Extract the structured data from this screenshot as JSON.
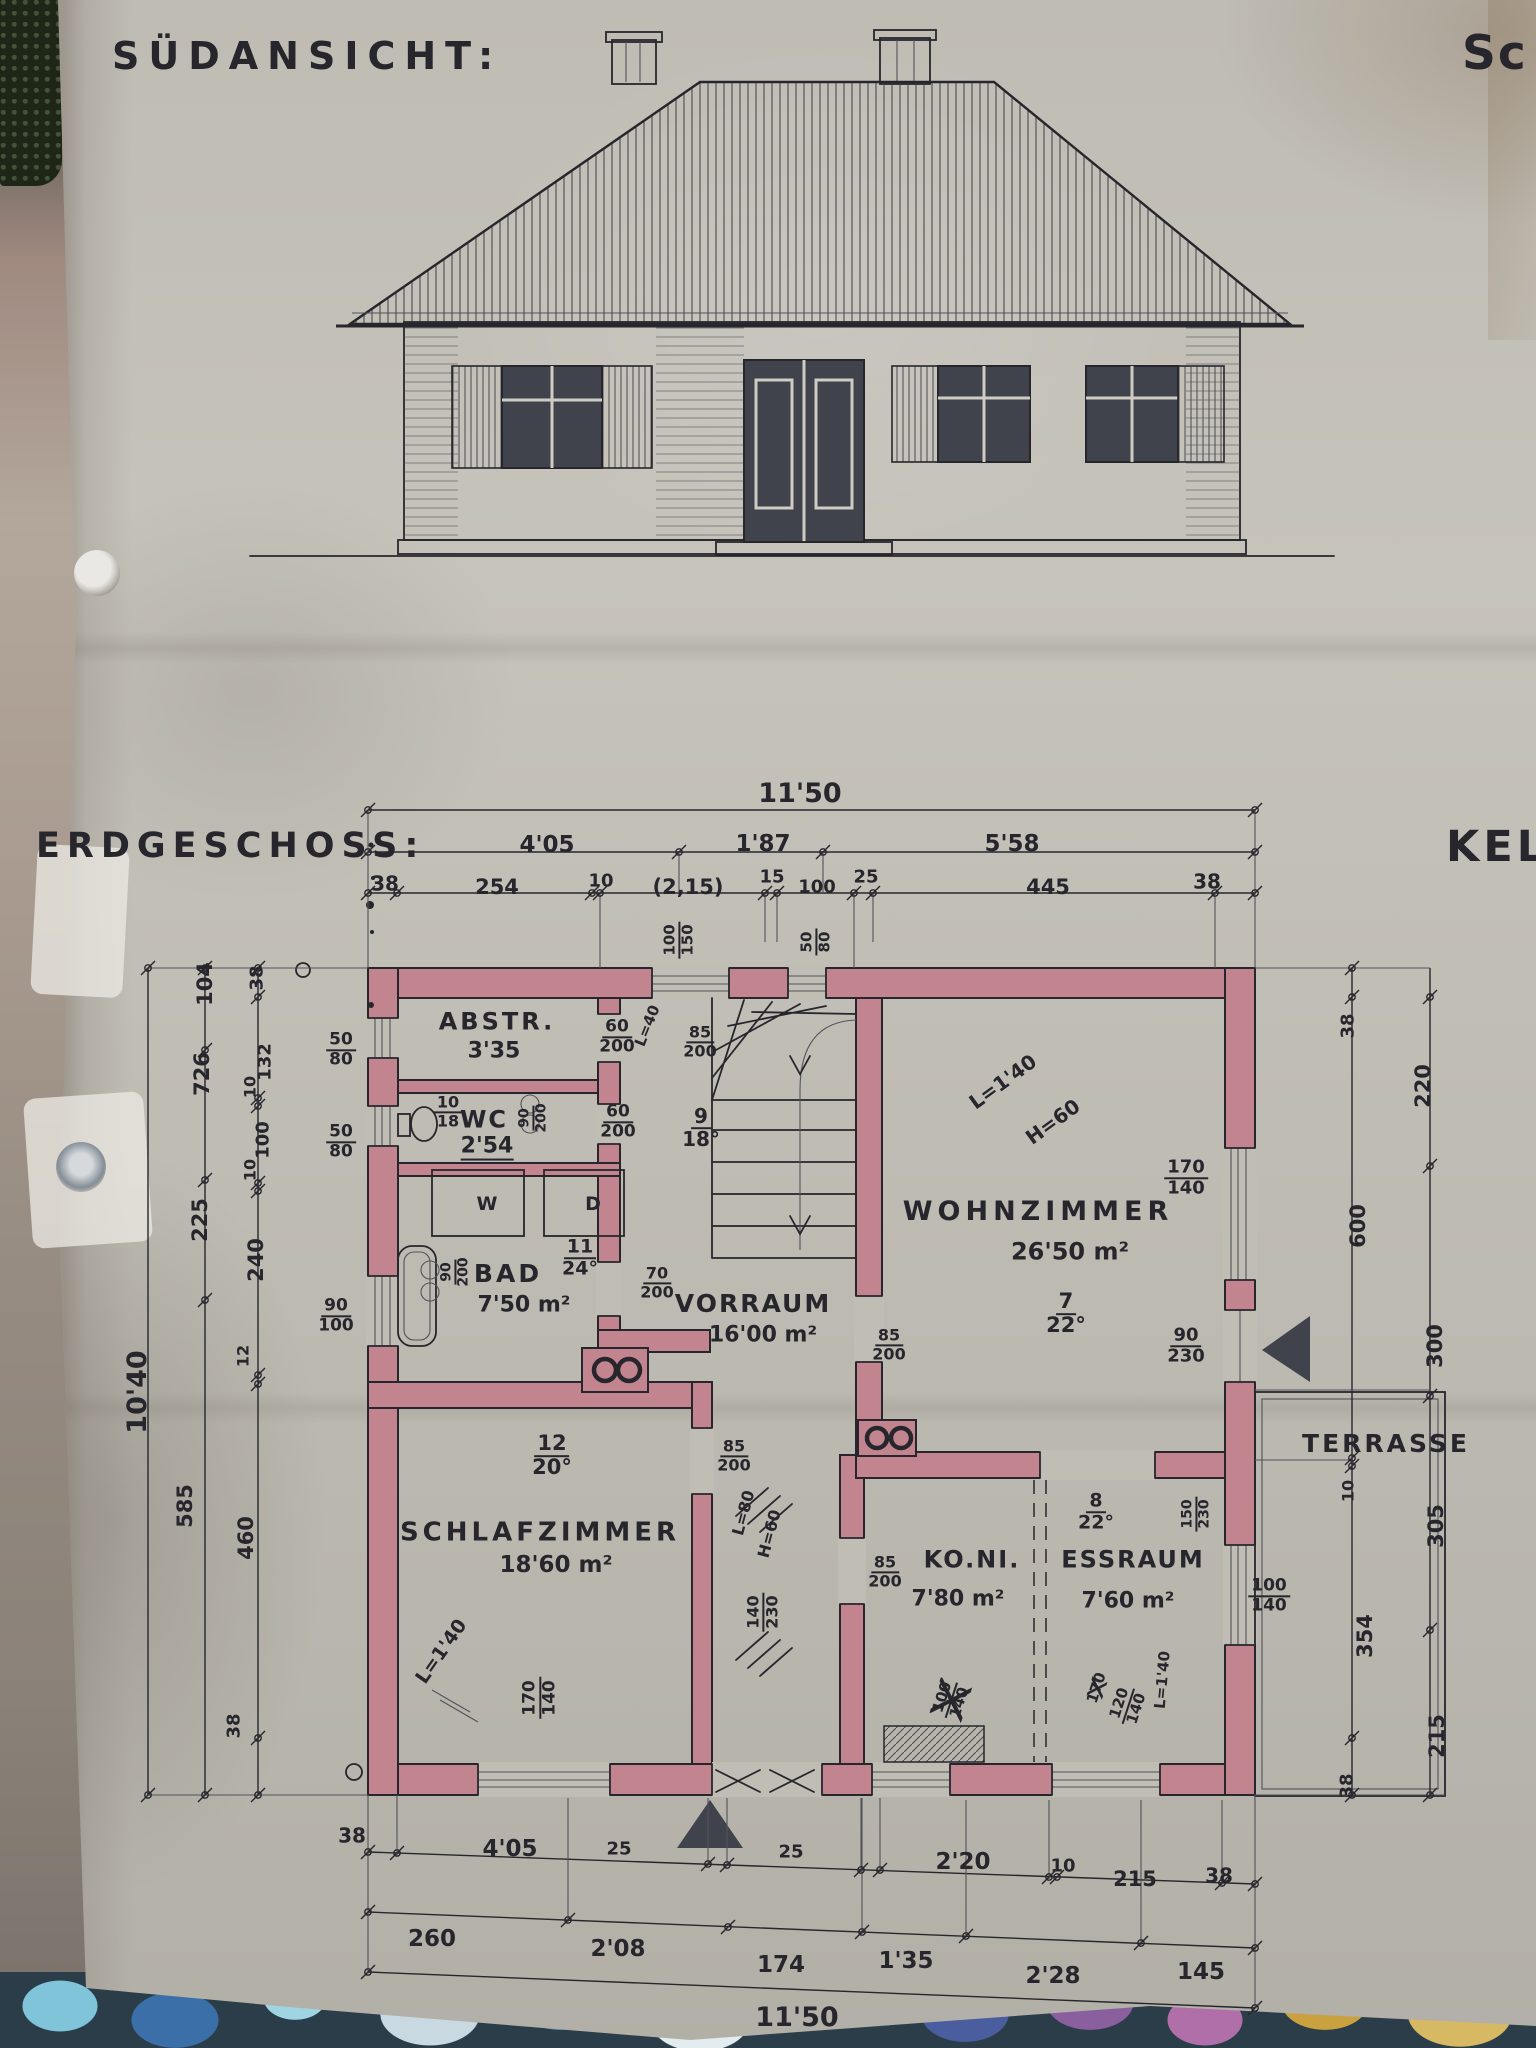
{
  "meta": {
    "title_south": "SÜDANSICHT:",
    "title_ground": "ERDGESCHOSS:",
    "clip_top_right": "Sc",
    "clip_mid_right": "KEL"
  },
  "colors": {
    "paper": "#c0bdb5",
    "ink": "#26262c",
    "pencil": "#52525a",
    "wall": "#c2848e",
    "glass": "#41434c",
    "frame": "#cfccc4"
  },
  "labels": [
    {
      "n": "dim-overall-top",
      "t": "11'50",
      "x": 800,
      "y": 794,
      "s": 27
    },
    {
      "n": "dim-top-405",
      "t": "4'05",
      "x": 547,
      "y": 846,
      "s": 23
    },
    {
      "n": "dim-top-187",
      "t": "1'87",
      "x": 763,
      "y": 845,
      "s": 23
    },
    {
      "n": "dim-top-558",
      "t": "5'58",
      "x": 1012,
      "y": 845,
      "s": 23
    },
    {
      "n": "dim-top-38-left",
      "t": "38",
      "x": 385,
      "y": 884,
      "s": 20
    },
    {
      "n": "dim-top-254",
      "t": "254",
      "x": 497,
      "y": 888,
      "s": 21
    },
    {
      "n": "dim-top-10",
      "t": "10",
      "x": 601,
      "y": 882,
      "s": 18
    },
    {
      "n": "dim-top-215",
      "t": "(2,15)",
      "x": 688,
      "y": 888,
      "s": 21
    },
    {
      "n": "dim-top-15",
      "t": "15",
      "x": 772,
      "y": 878,
      "s": 18
    },
    {
      "n": "dim-top-100",
      "t": "100",
      "x": 817,
      "y": 888,
      "s": 18
    },
    {
      "n": "dim-top-25",
      "t": "25",
      "x": 866,
      "y": 878,
      "s": 18
    },
    {
      "n": "dim-top-445",
      "t": "445",
      "x": 1048,
      "y": 888,
      "s": 21
    },
    {
      "n": "dim-top-38-right",
      "t": "38",
      "x": 1207,
      "y": 882,
      "s": 20
    },
    {
      "n": "dim-left-1040",
      "t": "10'40",
      "x": 138,
      "y": 1392,
      "r": -90,
      "s": 27
    },
    {
      "n": "dim-left-104",
      "t": "104",
      "x": 206,
      "y": 984,
      "r": -90,
      "s": 21
    },
    {
      "n": "dim-left-726",
      "t": "726",
      "x": 203,
      "y": 1074,
      "r": -90,
      "s": 21
    },
    {
      "n": "dim-left-225",
      "t": "225",
      "x": 201,
      "y": 1220,
      "r": -90,
      "s": 21
    },
    {
      "n": "dim-left-585",
      "t": "585",
      "x": 186,
      "y": 1506,
      "r": -90,
      "s": 21
    },
    {
      "n": "dim-left-38a",
      "t": "38",
      "x": 258,
      "y": 978,
      "r": -90,
      "s": 18
    },
    {
      "n": "dim-left-132",
      "t": "132",
      "x": 266,
      "y": 1062,
      "r": -90,
      "s": 18
    },
    {
      "n": "dim-left-10a",
      "t": "10",
      "x": 251,
      "y": 1087,
      "r": -90,
      "s": 16
    },
    {
      "n": "dim-left-100",
      "t": "100",
      "x": 264,
      "y": 1140,
      "r": -90,
      "s": 18
    },
    {
      "n": "dim-left-10b",
      "t": "10",
      "x": 251,
      "y": 1170,
      "r": -90,
      "s": 16
    },
    {
      "n": "dim-left-240",
      "t": "240",
      "x": 257,
      "y": 1260,
      "r": -90,
      "s": 21
    },
    {
      "n": "dim-left-12",
      "t": "12",
      "x": 244,
      "y": 1356,
      "r": -90,
      "s": 16
    },
    {
      "n": "dim-left-460",
      "t": "460",
      "x": 247,
      "y": 1538,
      "r": -90,
      "s": 21
    },
    {
      "n": "dim-left-38b",
      "t": "38",
      "x": 235,
      "y": 1726,
      "r": -90,
      "s": 18
    },
    {
      "n": "win-abstr-5080",
      "f": [
        "50",
        "80"
      ],
      "x": 341,
      "y": 1050,
      "s": 17
    },
    {
      "n": "win-wc-5080",
      "f": [
        "50",
        "80"
      ],
      "x": 341,
      "y": 1142,
      "s": 17
    },
    {
      "n": "win-bad-90100",
      "f": [
        "90",
        "100"
      ],
      "x": 336,
      "y": 1316,
      "s": 17
    },
    {
      "n": "dim-right-38a",
      "t": "38",
      "x": 1349,
      "y": 1026,
      "r": -90,
      "s": 18
    },
    {
      "n": "dim-right-220",
      "t": "220",
      "x": 1424,
      "y": 1086,
      "r": -90,
      "s": 21
    },
    {
      "n": "dim-right-600",
      "t": "600",
      "x": 1359,
      "y": 1226,
      "r": -90,
      "s": 21
    },
    {
      "n": "dim-right-300",
      "t": "300",
      "x": 1436,
      "y": 1346,
      "r": -90,
      "s": 21
    },
    {
      "n": "dim-right-10",
      "t": "10",
      "x": 1349,
      "y": 1491,
      "r": -90,
      "s": 16
    },
    {
      "n": "dim-right-305",
      "t": "305",
      "x": 1437,
      "y": 1526,
      "r": -90,
      "s": 21
    },
    {
      "n": "dim-right-354",
      "t": "354",
      "x": 1366,
      "y": 1636,
      "r": -90,
      "s": 21
    },
    {
      "n": "dim-right-215",
      "t": "215",
      "x": 1438,
      "y": 1736,
      "r": -90,
      "s": 21
    },
    {
      "n": "dim-right-38b",
      "t": "38",
      "x": 1348,
      "y": 1786,
      "r": -90,
      "s": 18
    },
    {
      "n": "dim-bottom-38-left",
      "t": "38",
      "x": 352,
      "y": 1836,
      "s": 20
    },
    {
      "n": "dim-bottom-405",
      "t": "4'05",
      "x": 510,
      "y": 1850,
      "s": 23
    },
    {
      "n": "dim-bottom-25a",
      "t": "25",
      "x": 619,
      "y": 1850,
      "s": 18
    },
    {
      "n": "dim-bottom-25b",
      "t": "25",
      "x": 791,
      "y": 1853,
      "s": 18
    },
    {
      "n": "dim-bottom-220",
      "t": "2'20",
      "x": 963,
      "y": 1863,
      "s": 23
    },
    {
      "n": "dim-bottom-10",
      "t": "10",
      "x": 1063,
      "y": 1867,
      "s": 18
    },
    {
      "n": "dim-bottom-215",
      "t": "215",
      "x": 1135,
      "y": 1880,
      "s": 21
    },
    {
      "n": "dim-bottom-38-right",
      "t": "38",
      "x": 1219,
      "y": 1876,
      "s": 20
    },
    {
      "n": "dim-bottom2-260",
      "t": "260",
      "x": 432,
      "y": 1940,
      "s": 23
    },
    {
      "n": "dim-bottom2-208",
      "t": "2'08",
      "x": 618,
      "y": 1950,
      "s": 23
    },
    {
      "n": "dim-bottom2-174",
      "t": "174",
      "x": 781,
      "y": 1966,
      "s": 23
    },
    {
      "n": "dim-bottom2-135",
      "t": "1'35",
      "x": 906,
      "y": 1962,
      "s": 23
    },
    {
      "n": "dim-bottom2-228",
      "t": "2'28",
      "x": 1053,
      "y": 1977,
      "s": 23
    },
    {
      "n": "dim-bottom2-145",
      "t": "145",
      "x": 1201,
      "y": 1973,
      "s": 23
    },
    {
      "n": "dim-overall-bottom",
      "t": "11'50",
      "x": 797,
      "y": 2018,
      "s": 27
    },
    {
      "n": "room-abstellraum-name",
      "t": "ABSTR.",
      "x": 497,
      "y": 1022,
      "s": 24,
      "ls": 3
    },
    {
      "n": "room-abstellraum-size",
      "t": "3'35",
      "x": 494,
      "y": 1052,
      "s": 22
    },
    {
      "n": "note-wc-frac",
      "f": [
        "10",
        "18"
      ],
      "x": 448,
      "y": 1112,
      "s": 16
    },
    {
      "n": "room-wc-name",
      "t": "WC",
      "x": 484,
      "y": 1120,
      "s": 24,
      "ls": 2
    },
    {
      "n": "room-wc-size",
      "t": "2'54",
      "x": 487,
      "y": 1148,
      "s": 22,
      "c": "u"
    },
    {
      "n": "door-abstr-60200",
      "f": [
        "60",
        "200"
      ],
      "x": 617,
      "y": 1037,
      "s": 17
    },
    {
      "n": "door-wc-60200",
      "f": [
        "60",
        "200"
      ],
      "x": 618,
      "y": 1122,
      "s": 17
    },
    {
      "n": "note-l40",
      "t": "L=40",
      "x": 648,
      "y": 1026,
      "r": -68,
      "s": 15
    },
    {
      "n": "door-wc-90200",
      "f": [
        "90",
        "200"
      ],
      "x": 533,
      "y": 1118,
      "r": -90,
      "s": 14
    },
    {
      "n": "win-top-100150",
      "f": [
        "100",
        "150"
      ],
      "x": 679,
      "y": 940,
      "r": -90,
      "s": 15
    },
    {
      "n": "win-top-5080",
      "f": [
        "50",
        "80"
      ],
      "x": 816,
      "y": 942,
      "r": -90,
      "s": 15
    },
    {
      "n": "door-stair-85200",
      "f": [
        "85",
        "200"
      ],
      "x": 700,
      "y": 1042,
      "s": 16
    },
    {
      "n": "note-stair-frac",
      "f": [
        "9",
        "18°"
      ],
      "x": 701,
      "y": 1128,
      "s": 20
    },
    {
      "n": "room-bad-name",
      "t": "BAD",
      "x": 508,
      "y": 1274,
      "s": 25,
      "ls": 3
    },
    {
      "n": "room-bad-area",
      "t": "7'50 m²",
      "x": 524,
      "y": 1306,
      "s": 22
    },
    {
      "n": "note-bad-frac",
      "f": [
        "11",
        "24°"
      ],
      "x": 580,
      "y": 1258,
      "s": 19
    },
    {
      "n": "door-bad-90200",
      "f": [
        "90",
        "200"
      ],
      "x": 455,
      "y": 1272,
      "r": -90,
      "s": 14
    },
    {
      "n": "door-vorraum-bad-70200",
      "f": [
        "70",
        "200"
      ],
      "x": 657,
      "y": 1283,
      "s": 16
    },
    {
      "n": "fixture-bathtub-label",
      "t": "W",
      "x": 487,
      "y": 1205,
      "s": 19
    },
    {
      "n": "fixture-shower-label",
      "t": "D",
      "x": 593,
      "y": 1205,
      "s": 19
    },
    {
      "n": "room-vorraum-name",
      "t": "VORRAUM",
      "x": 753,
      "y": 1304,
      "s": 25,
      "ls": 2
    },
    {
      "n": "room-vorraum-area",
      "t": "16'00 m²",
      "x": 763,
      "y": 1336,
      "s": 22
    },
    {
      "n": "door-wohnzimmer-85200",
      "f": [
        "85",
        "200"
      ],
      "x": 889,
      "y": 1345,
      "s": 16
    },
    {
      "n": "door-schlafzimmer-85200",
      "f": [
        "85",
        "200"
      ],
      "x": 734,
      "y": 1456,
      "s": 16
    },
    {
      "n": "door-corridor-140230",
      "f": [
        "140",
        "230"
      ],
      "x": 763,
      "y": 1612,
      "r": -90,
      "s": 16
    },
    {
      "n": "note-corridor-l80",
      "t": "L=80",
      "x": 744,
      "y": 1513,
      "r": -75,
      "s": 16
    },
    {
      "n": "note-corridor-h60",
      "t": "H=60",
      "x": 770,
      "y": 1534,
      "r": -75,
      "s": 16
    },
    {
      "n": "room-wohnzimmer-name",
      "t": "WOHNZIMMER",
      "x": 1038,
      "y": 1212,
      "s": 27,
      "ls": 5
    },
    {
      "n": "room-wohnzimmer-area",
      "t": "26'50 m²",
      "x": 1070,
      "y": 1252,
      "s": 24
    },
    {
      "n": "note-wohnzimmer-frac",
      "f": [
        "7",
        "22°"
      ],
      "x": 1066,
      "y": 1314,
      "s": 21
    },
    {
      "n": "note-wohnzimmer-l140",
      "t": "L=1'40",
      "x": 1003,
      "y": 1082,
      "r": -36,
      "s": 20
    },
    {
      "n": "note-wohnzimmer-h60",
      "t": "H=60",
      "x": 1053,
      "y": 1122,
      "r": -36,
      "s": 20
    },
    {
      "n": "win-wohnzimmer-170140",
      "f": [
        "170",
        "140"
      ],
      "x": 1186,
      "y": 1178,
      "s": 18
    },
    {
      "n": "door-terrasse-90230",
      "f": [
        "90",
        "230"
      ],
      "x": 1186,
      "y": 1346,
      "s": 18
    },
    {
      "n": "note-schlafzimmer-frac",
      "f": [
        "12",
        "20°"
      ],
      "x": 552,
      "y": 1456,
      "s": 21
    },
    {
      "n": "room-schlafzimmer-name",
      "t": "SCHLAFZIMMER",
      "x": 540,
      "y": 1533,
      "s": 26,
      "ls": 4
    },
    {
      "n": "room-schlafzimmer-area",
      "t": "18'60 m²",
      "x": 556,
      "y": 1566,
      "s": 23
    },
    {
      "n": "note-schlafzimmer-l140",
      "t": "L=1'40",
      "x": 442,
      "y": 1652,
      "r": -55,
      "s": 19
    },
    {
      "n": "win-schlafzimmer-170140",
      "f": [
        "170",
        "140"
      ],
      "x": 540,
      "y": 1698,
      "r": -90,
      "s": 17
    },
    {
      "n": "room-kochnische-name",
      "t": "KO.NI.",
      "x": 972,
      "y": 1560,
      "s": 24,
      "ls": 2
    },
    {
      "n": "room-kochnische-area",
      "t": "7'80 m²",
      "x": 958,
      "y": 1600,
      "s": 22
    },
    {
      "n": "door-kochnische-85200",
      "f": [
        "85",
        "200"
      ],
      "x": 885,
      "y": 1572,
      "s": 16
    },
    {
      "n": "room-essraum-name",
      "t": "ESSRAUM",
      "x": 1133,
      "y": 1560,
      "s": 24,
      "ls": 2
    },
    {
      "n": "room-essraum-area",
      "t": "7'60 m²",
      "x": 1128,
      "y": 1602,
      "s": 22
    },
    {
      "n": "note-essraum-frac",
      "f": [
        "8",
        "22°"
      ],
      "x": 1096,
      "y": 1512,
      "s": 19
    },
    {
      "n": "win-essraum-100140",
      "f": [
        "100",
        "140"
      ],
      "x": 1269,
      "y": 1596,
      "s": 17
    },
    {
      "n": "door-wohn-ess-150230",
      "f": [
        "150",
        "230"
      ],
      "x": 1196,
      "y": 1514,
      "r": -90,
      "s": 14
    },
    {
      "n": "win-koni-100140-crossed",
      "f": [
        "100",
        "140"
      ],
      "x": 951,
      "y": 1700,
      "r": -72,
      "s": 15,
      "c": "crossed"
    },
    {
      "n": "win-ess-170-crossed",
      "t": "170",
      "x": 1097,
      "y": 1688,
      "r": -72,
      "s": 15,
      "c": "crossed"
    },
    {
      "n": "win-ess-120140",
      "f": [
        "120",
        "140"
      ],
      "x": 1128,
      "y": 1706,
      "r": -72,
      "s": 15
    },
    {
      "n": "note-ess-l140",
      "t": "L=1'40",
      "x": 1163,
      "y": 1680,
      "r": -85,
      "s": 15
    },
    {
      "n": "area-terrasse-name",
      "t": "TERRASSE",
      "x": 1386,
      "y": 1444,
      "s": 25,
      "ls": 3
    }
  ]
}
